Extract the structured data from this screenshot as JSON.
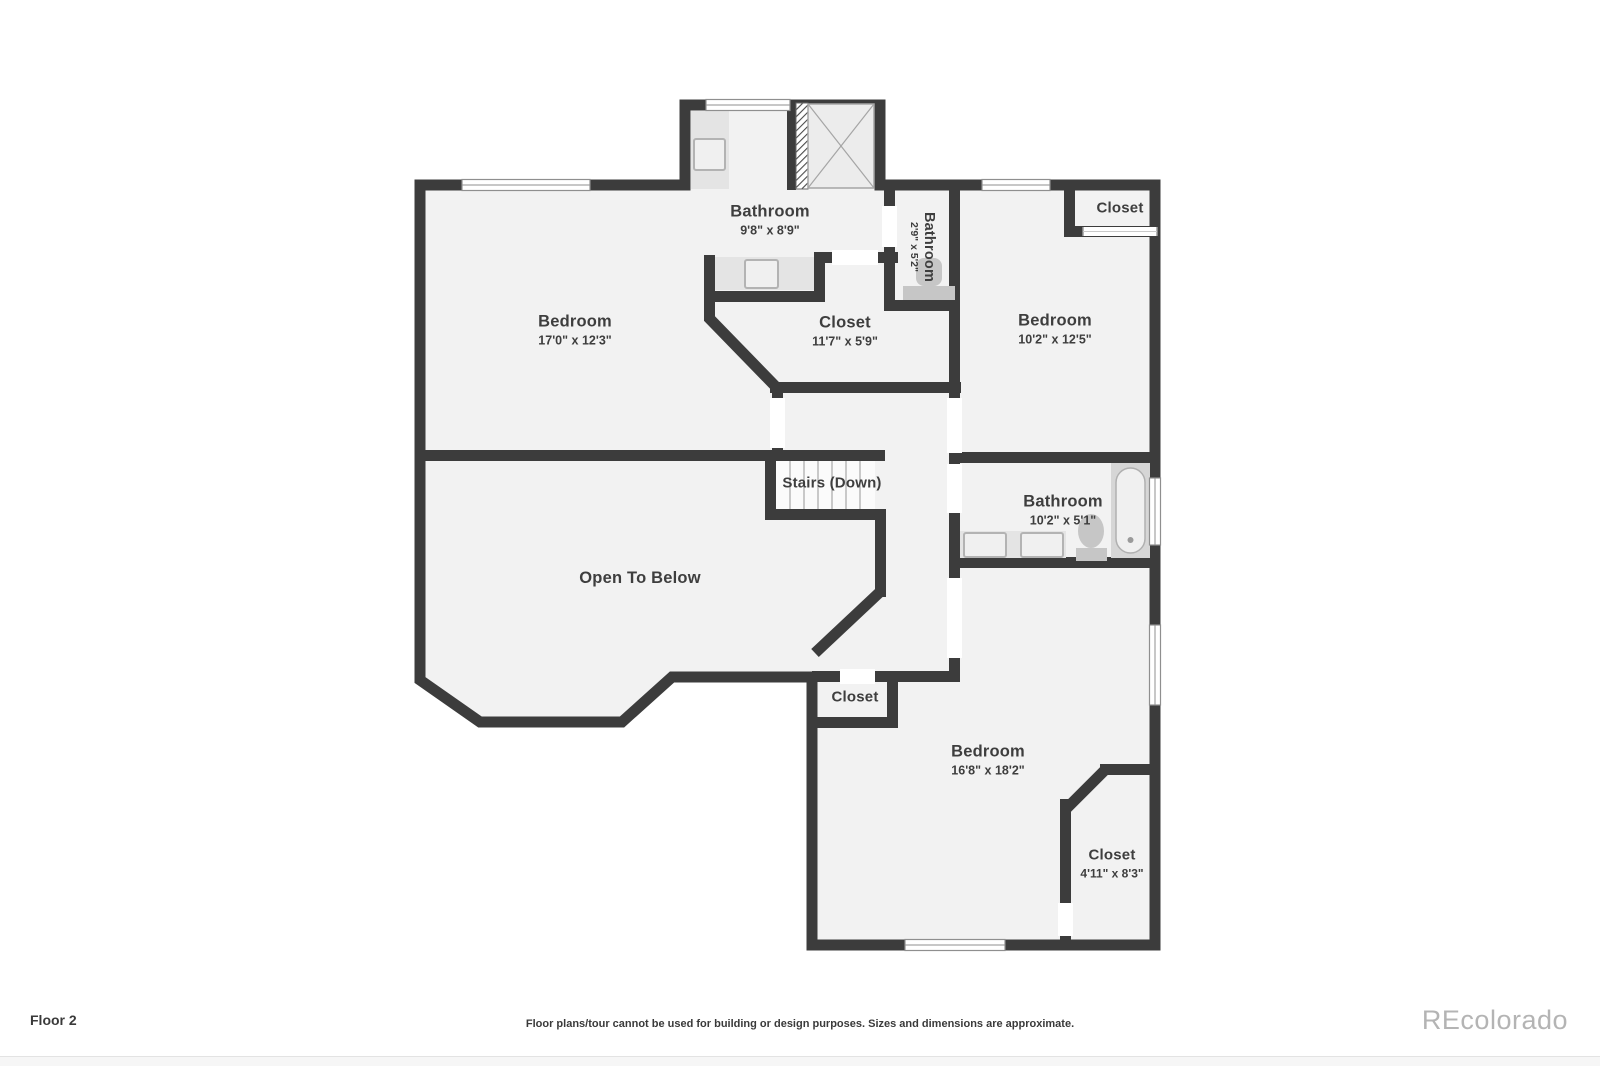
{
  "plan": {
    "wall_color": "#3c3c3c",
    "floor_color": "#f2f2f2",
    "fixture_color": "#e4e4e4",
    "window_color": "#ffffff"
  },
  "rooms": {
    "bathroom_top": {
      "name": "Bathroom",
      "dims": "9'8\" x 8'9\""
    },
    "bathroom_small": {
      "name": "Bathroom",
      "dims": "2'9\" x 5'2\""
    },
    "closet_top_right": {
      "name": "Closet"
    },
    "bedroom_left": {
      "name": "Bedroom",
      "dims": "17'0\" x 12'3\""
    },
    "closet_walkin": {
      "name": "Closet",
      "dims": "11'7\" x 5'9\""
    },
    "bedroom_right": {
      "name": "Bedroom",
      "dims": "10'2\" x 12'5\""
    },
    "stairs": {
      "name": "Stairs (Down)"
    },
    "bathroom_hall": {
      "name": "Bathroom",
      "dims": "10'2\" x 5'1\""
    },
    "open_to_below": {
      "name": "Open To Below"
    },
    "closet_hall": {
      "name": "Closet"
    },
    "bedroom_bottom": {
      "name": "Bedroom",
      "dims": "16'8\" x 18'2\""
    },
    "closet_bottom_right": {
      "name": "Closet",
      "dims": "4'11\" x 8'3\""
    }
  },
  "footer": {
    "floor_label": "Floor 2",
    "disclaimer": "Floor plans/tour cannot be used for building or design purposes. Sizes and dimensions are approximate.",
    "brand": "REcolorado"
  }
}
